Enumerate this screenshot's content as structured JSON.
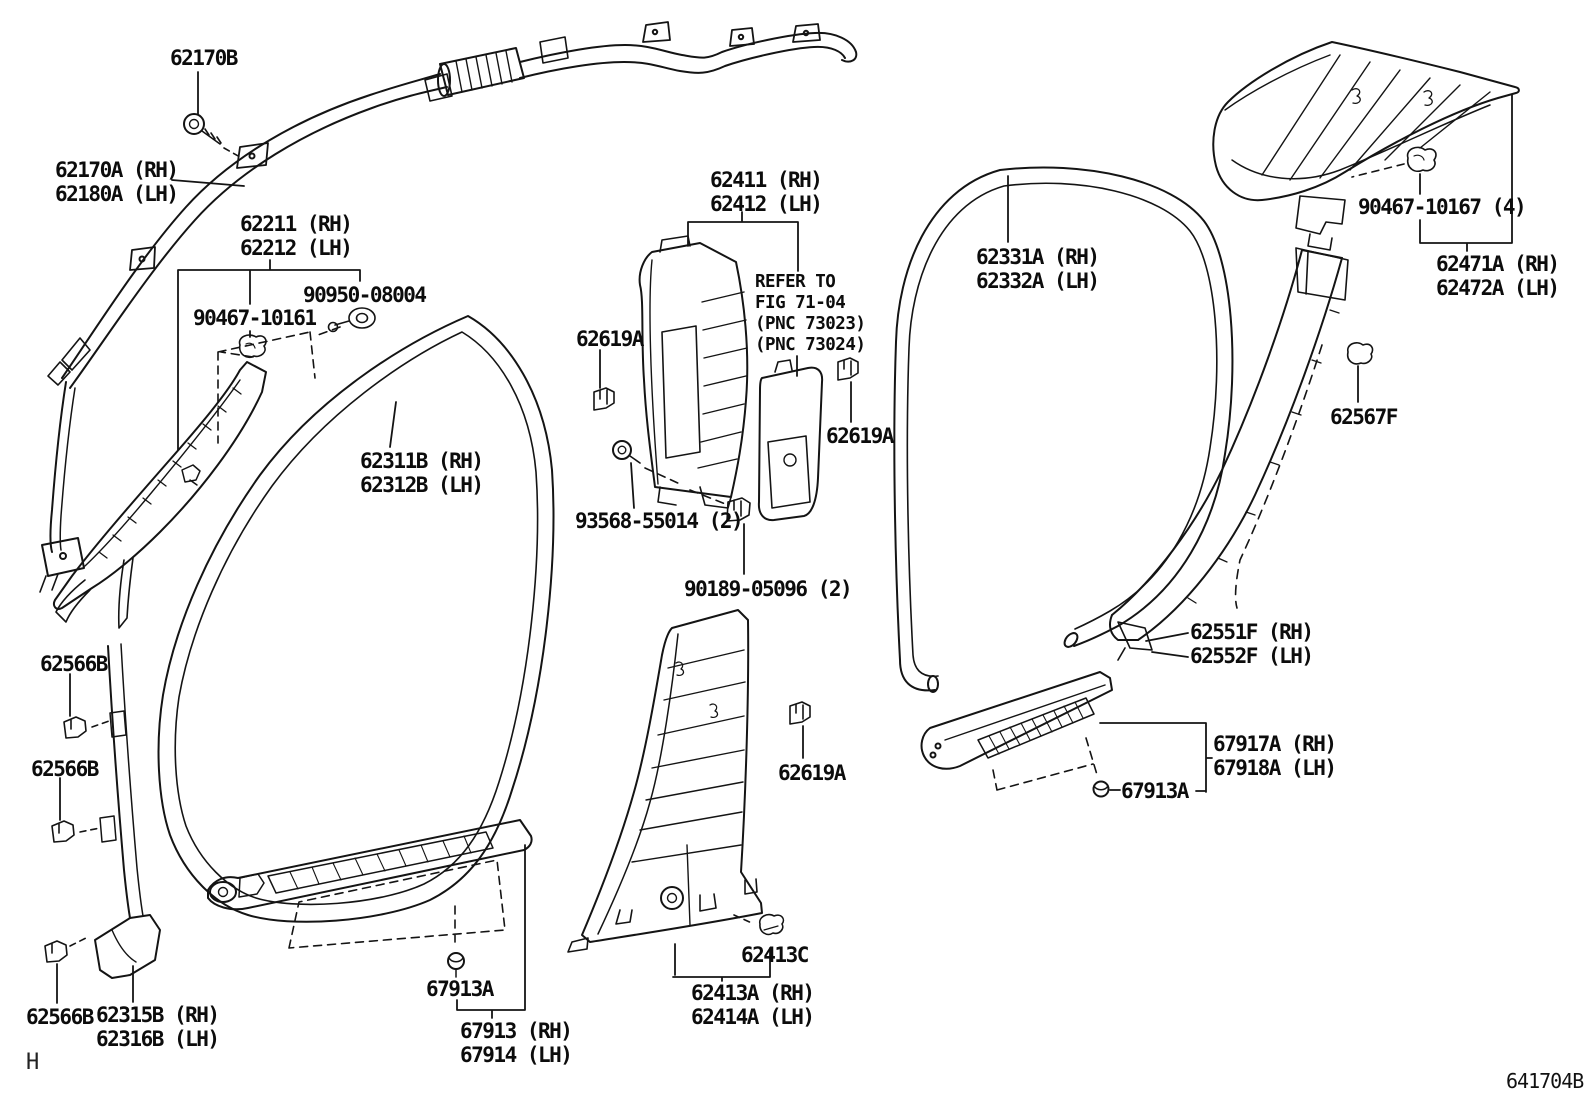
{
  "diagram": {
    "type": "vehicle-interior-trim-parts-diagram",
    "page_marker": "H",
    "drawing_code": "641704B",
    "labels": [
      {
        "id": "62170B",
        "x": 170,
        "y": 46,
        "lines": [
          "62170B"
        ]
      },
      {
        "id": "62170A-62180A",
        "x": 55,
        "y": 158,
        "lines": [
          "62170A (RH)",
          "62180A (LH)"
        ]
      },
      {
        "id": "62211-62212",
        "x": 240,
        "y": 212,
        "lines": [
          "62211 (RH)",
          "62212 (LH)"
        ]
      },
      {
        "id": "90950-08004",
        "x": 303,
        "y": 283,
        "lines": [
          "90950-08004"
        ]
      },
      {
        "id": "90467-10161",
        "x": 193,
        "y": 306,
        "lines": [
          "90467-10161"
        ]
      },
      {
        "id": "62411-62412",
        "x": 710,
        "y": 168,
        "lines": [
          "62411 (RH)",
          "62412 (LH)"
        ]
      },
      {
        "id": "refer-note",
        "x": 755,
        "y": 272,
        "small": true,
        "lines": [
          "REFER TO",
          "FIG 71-04",
          "(PNC 73023)",
          "(PNC 73024)"
        ]
      },
      {
        "id": "62619A-1",
        "x": 576,
        "y": 327,
        "lines": [
          "62619A"
        ]
      },
      {
        "id": "62619A-2",
        "x": 826,
        "y": 424,
        "lines": [
          "62619A"
        ]
      },
      {
        "id": "62619A-3",
        "x": 778,
        "y": 761,
        "lines": [
          "62619A"
        ]
      },
      {
        "id": "62331A-62332A",
        "x": 976,
        "y": 245,
        "lines": [
          "62331A (RH)",
          "62332A (LH)"
        ]
      },
      {
        "id": "90467-10167",
        "x": 1358,
        "y": 195,
        "lines": [
          "90467-10167 (4)"
        ]
      },
      {
        "id": "62471A-62472A",
        "x": 1436,
        "y": 252,
        "lines": [
          "62471A (RH)",
          "62472A (LH)"
        ]
      },
      {
        "id": "62567F",
        "x": 1330,
        "y": 405,
        "lines": [
          "62567F"
        ]
      },
      {
        "id": "62551F-62552F",
        "x": 1190,
        "y": 620,
        "lines": [
          "62551F (RH)",
          "62552F (LH)"
        ]
      },
      {
        "id": "62311B-62312B",
        "x": 360,
        "y": 449,
        "lines": [
          "62311B (RH)",
          "62312B (LH)"
        ]
      },
      {
        "id": "93568-55014",
        "x": 575,
        "y": 509,
        "lines": [
          "93568-55014 (2)"
        ]
      },
      {
        "id": "90189-05096",
        "x": 684,
        "y": 577,
        "lines": [
          "90189-05096 (2)"
        ]
      },
      {
        "id": "62566B-1",
        "x": 40,
        "y": 652,
        "lines": [
          "62566B"
        ]
      },
      {
        "id": "62566B-2",
        "x": 31,
        "y": 757,
        "lines": [
          "62566B"
        ]
      },
      {
        "id": "62566B-3",
        "x": 26,
        "y": 1005,
        "lines": [
          "62566B"
        ]
      },
      {
        "id": "62315B-62316B",
        "x": 96,
        "y": 1003,
        "lines": [
          "62315B (RH)",
          "62316B (LH)"
        ]
      },
      {
        "id": "67913A-left",
        "x": 426,
        "y": 977,
        "lines": [
          "67913A"
        ]
      },
      {
        "id": "67913-67914",
        "x": 460,
        "y": 1019,
        "lines": [
          "67913 (RH)",
          "67914 (LH)"
        ]
      },
      {
        "id": "62413C",
        "x": 741,
        "y": 943,
        "lines": [
          "62413C"
        ]
      },
      {
        "id": "62413A-62414A",
        "x": 691,
        "y": 981,
        "lines": [
          "62413A (RH)",
          "62414A (LH)"
        ]
      },
      {
        "id": "67917A-67918A",
        "x": 1213,
        "y": 732,
        "lines": [
          "67917A (RH)",
          "67918A (LH)"
        ]
      },
      {
        "id": "67913A-right",
        "x": 1121,
        "y": 779,
        "lines": [
          "67913A"
        ]
      }
    ]
  }
}
